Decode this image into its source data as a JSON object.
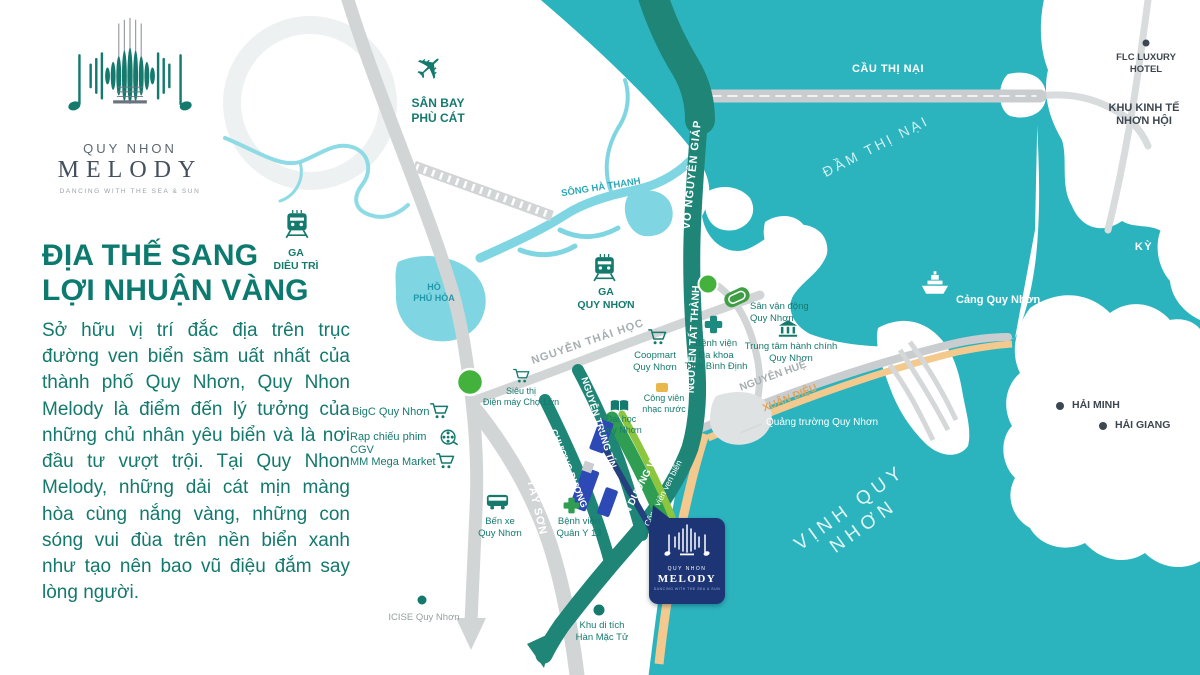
{
  "logo": {
    "brand_top": "QUY NHON",
    "brand_name": "MELODY",
    "tagline": "DANCING WITH THE SEA & SUN"
  },
  "panel": {
    "heading": "ĐỊA THẾ SANG\nLỢI NHUẬN VÀNG",
    "body": "Sở hữu vị trí đắc địa trên trục đường ven biển sầm uất nhất của thành phố Quy Nhơn, Quy Nhon Melody là điểm đến lý tưởng của những chủ nhân yêu biển và là nơi đầu tư vượt trội. Tại Quy Nhon Melody, những dải cát mịn màng hòa cùng nắng vàng, những con sóng vui đùa trên nền biển xanh như tạo nên bao vũ điệu đắm say lòng người."
  },
  "map": {
    "water": {
      "dam_thi_nai": "ĐẦM THỊ NẠI",
      "vinh_quy_nhon": "VỊNH QUY NHƠN",
      "song_ha_thanh": "SÔNG HÀ THANH",
      "ho_phu_hoa": "HỒ\nPHÚ HÒA"
    },
    "roads": {
      "cau_thi_nai": "CẦU THỊ NẠI",
      "vo_nguyen_giap": "VÕ NGUYÊN GIÁP",
      "nguyen_tat_thanh": "NGUYỄN TẤT THÀNH",
      "nguyen_thai_hoc": "NGUYỄN THÁI HỌC",
      "nguyen_hue": "NGUYỄN HUỆ",
      "xuan_dieu": "XUÂN DIỆU",
      "nguyen_trung_tin": "NGUYỄN TRUNG TÍN",
      "chuong_duong": "CHƯƠNG DƯƠNG",
      "an_duong_vuong": "AN DƯƠNG VƯƠNG",
      "tay_son": "TÂY SƠN"
    },
    "places": {
      "san_bay": "SÂN BAY\nPHÙ CÁT",
      "ga_dieu_tri": "GA\nDIÊU TRÌ",
      "ga_quy_nhon": "GA\nQUY NHƠN",
      "flc": "FLC LUXURY\nHOTEL",
      "khu_kinh_te": "KHU KINH TẾ\nNHƠN HỘI",
      "ky_co": "KỲ CO",
      "cang_quy_nhon": "Cảng Quy Nhơn",
      "hai_minh": "HẢI MINH",
      "hai_giang": "HẢI GIANG",
      "coopmart": "Coopmart\nQuy Nhơn",
      "san_van_dong": "Sân vận động\nQuy Nhơn",
      "bv_da_khoa": "Bệnh viện\nĐa khoa\nTỉnh Bình Định",
      "trung_tam_hanh_chinh": "Trung tâm hành chính\nQuy Nhơn",
      "bigc": "BigC Quy Nhơn",
      "sieu_thi_dien_may": "Siêu thị\nĐiện máy Chợ Lớn",
      "cgv": "Rạp chiếu phim CGV",
      "mm_mega": "MM Mega Market",
      "cong_vien_nhac_nuoc": "Công viên\nnhạc nước",
      "dai_hoc": "Đại học\nQuy Nhơn",
      "cong_vien_ven_bien": "Công viên ven biển",
      "quang_truong": "Quảng trường Quy Nhơn",
      "ben_xe": "Bến xe\nQuy Nhơn",
      "bv_quan_y": "Bệnh viện\nQuân Y 13",
      "icise": "ICISE Quy Nhơn",
      "han_mac_tu": "Khu di tích\nHàn Mặc Tử"
    },
    "marker": {
      "brand_top": "QUY NHON",
      "brand_name": "MELODY",
      "tagline": "DANCING WITH THE SEA & SUN"
    }
  },
  "colors": {
    "sea": "#2cb4be",
    "river": "#7fd6e2",
    "road_teal": "#1e8577",
    "road_green": "#2f9e53",
    "park_green": "#8cc63f",
    "sand": "#f3c98e",
    "road_gray": "#d2d5d6",
    "navy": "#1e3575",
    "accent_teal": "#157a6e"
  }
}
